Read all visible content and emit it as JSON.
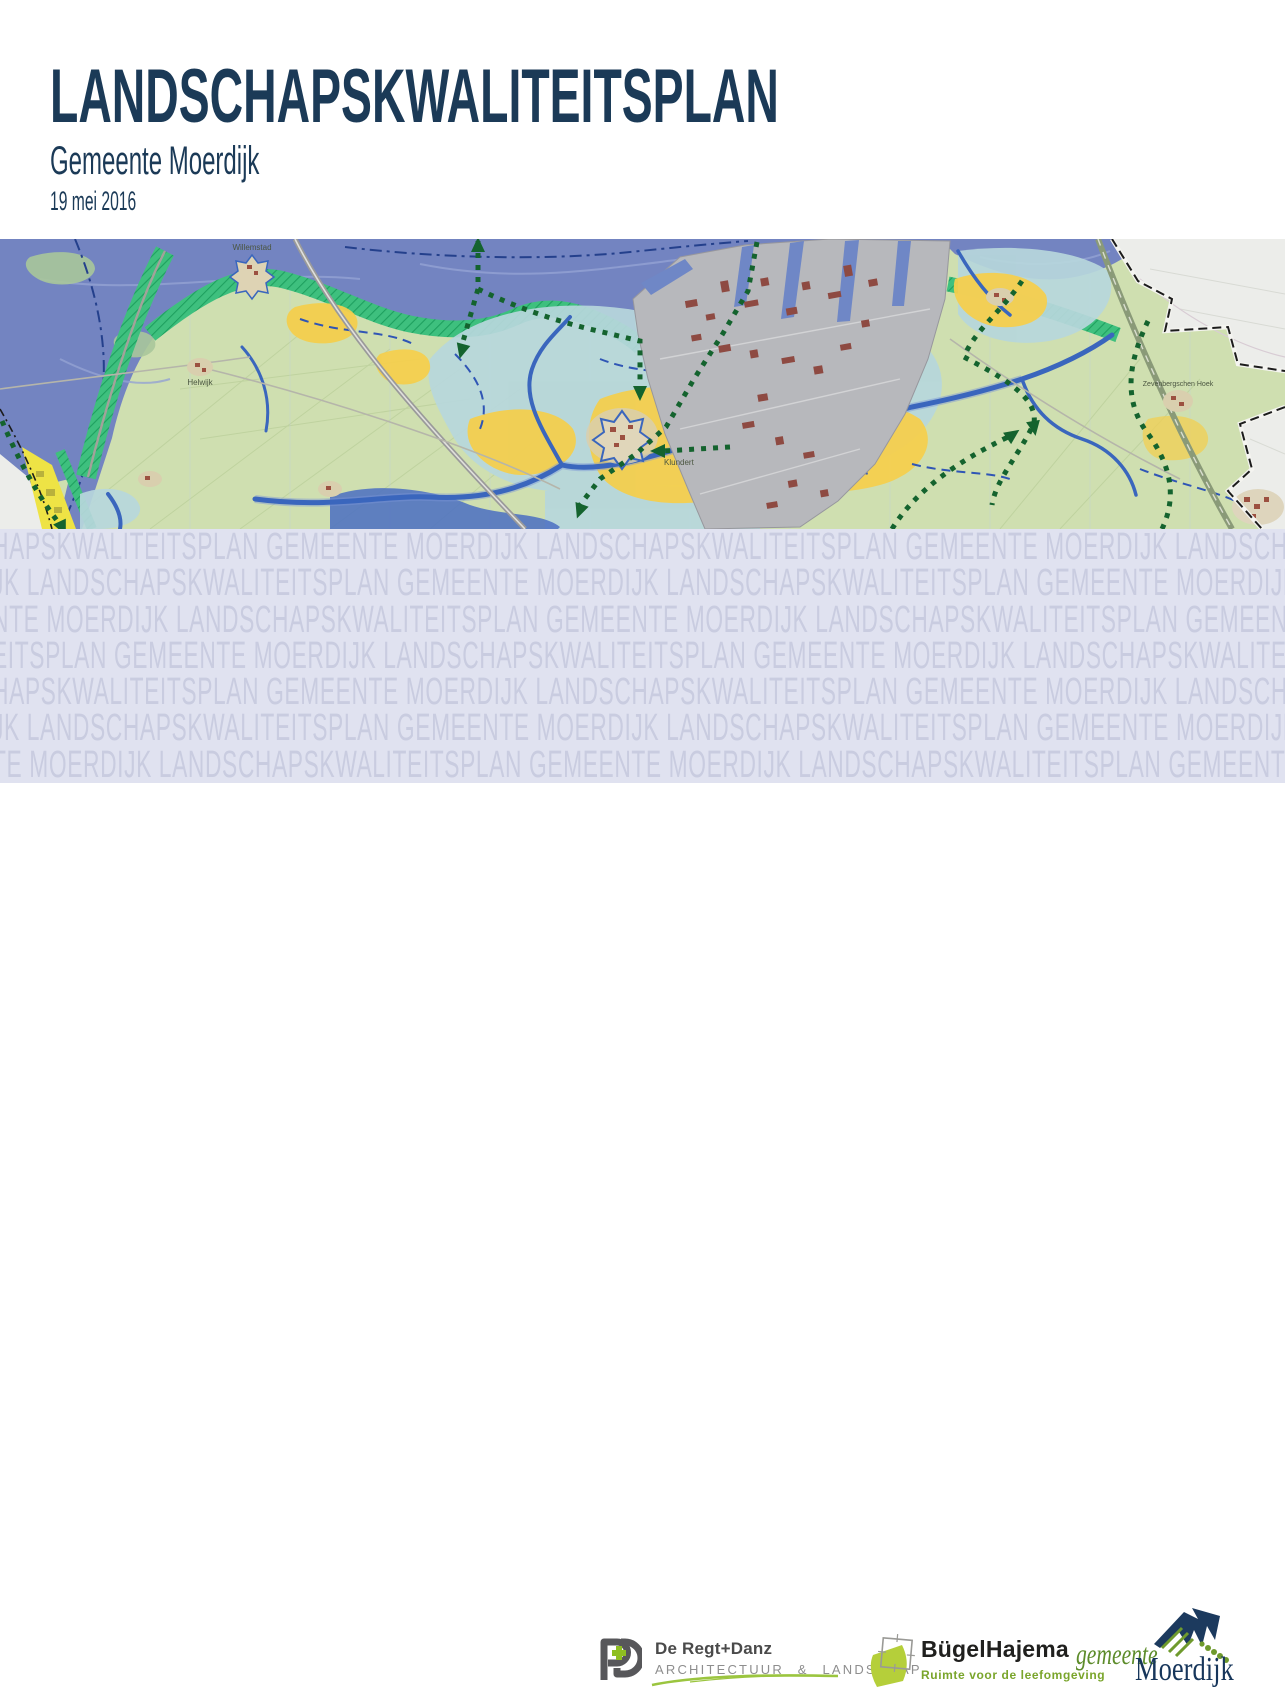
{
  "header": {
    "title": "LANDSCHAPSKWALITEITSPLAN",
    "subtitle": "Gemeente Moerdijk",
    "date": "19 mei 2016",
    "title_color": "#1b3a57"
  },
  "map": {
    "type": "topographic-plan-map",
    "area": "Gemeente Moerdijk",
    "labels": {
      "willemstad": "Willemstad",
      "helwijk": "Helwijk",
      "klundert": "Klundert",
      "zevenbergschen_hoek": "Zevenbergschen Hoek"
    },
    "legend_colors": {
      "water": "#7384c1",
      "polder_land": "#cfdfb0",
      "creek_zone_blue": "#b7d7dc",
      "open_polder_yellow": "#f4cf4e",
      "dike_zone_green": "#3ec07e",
      "industrial_area": "#b7b8bc",
      "industrial_buildings": "#8e4a42",
      "creeks": "#3a66bd",
      "route_dotted_green": "#14632e",
      "municipal_boundary": "#1c1c1c",
      "outside_plan_area": "#ecedea"
    }
  },
  "watermark": {
    "phrase": "LANDSCHAPSKWALITEITSPLAN GEMEENTE MOERDIJK",
    "background": "#e0e2f0",
    "text_color": "#c9cce0",
    "rows": [
      "HAPSKWALITEITSPLAN GEMEENTE MOERDIJK LANDSCHAPSKWALITEITSPLAN GEMEENTE MOERDIJK LANDSCHAPSKWALITEITSPLAN GEMEENTE MOERDIJK LANDSCHAPSKWALITEITSPLAN",
      "JK LANDSCHAPSKWALITEITSPLAN GEMEENTE MOERDIJK LANDSCHAPSKWALITEITSPLAN GEMEENTE MOERDIJK LANDSCHAPSKWALITEITSPLAN GEMEENTE MOERDIJK LANDSCHAPSKWALITEITSPLAN",
      "NTE MOERDIJK LANDSCHAPSKWALITEITSPLAN GEMEENTE MOERDIJK LANDSCHAPSKWALITEITSPLAN GEMEENTE MOERDIJK LANDSCHAPSKWALITEITSPLAN GEMEENTE MOERDIJK",
      "EITSPLAN GEMEENTE MOERDIJK LANDSCHAPSKWALITEITSPLAN GEMEENTE MOERDIJK LANDSCHAPSKWALITEITSPLAN GEMEENTE MOERDIJK LANDSCHAPSKWALITEITSPLAN GEMEENTE",
      "HAPSKWALITEITSPLAN GEMEENTE MOERDIJK LANDSCHAPSKWALITEITSPLAN GEMEENTE MOERDIJK LANDSCHAPSKWALITEITSPLAN GEMEENTE MOERDIJK LANDSCHAPSKWALITEITSPLAN",
      "JK LANDSCHAPSKWALITEITSPLAN GEMEENTE MOERDIJK LANDSCHAPSKWALITEITSPLAN GEMEENTE MOERDIJK LANDSCHAPSKWALITEITSPLAN GEMEENTE MOERDIJK LANDSCHAPSKWALITEITSPLAN",
      "TE MOERDIJK LANDSCHAPSKWALITEITSPLAN GEMEENTE MOERDIJK LANDSCHAPSKWALITEITSPLAN GEMEENTE MOERDIJK LANDSCHAPSKWALITEITSPLAN GEMEENTE MOERDIJK"
    ]
  },
  "footer": {
    "logos": [
      {
        "id": "de-regt-danz",
        "line1": "De Regt+Danz",
        "line2": "ARCHITECTUUR & LANDSCHAP"
      },
      {
        "id": "bugelhajema",
        "line1": "BügelHajema",
        "line2": "Ruimte voor de leefomgeving"
      },
      {
        "id": "gemeente-moerdijk",
        "line1": "gemeente",
        "line2": "Moerdijk"
      }
    ]
  }
}
